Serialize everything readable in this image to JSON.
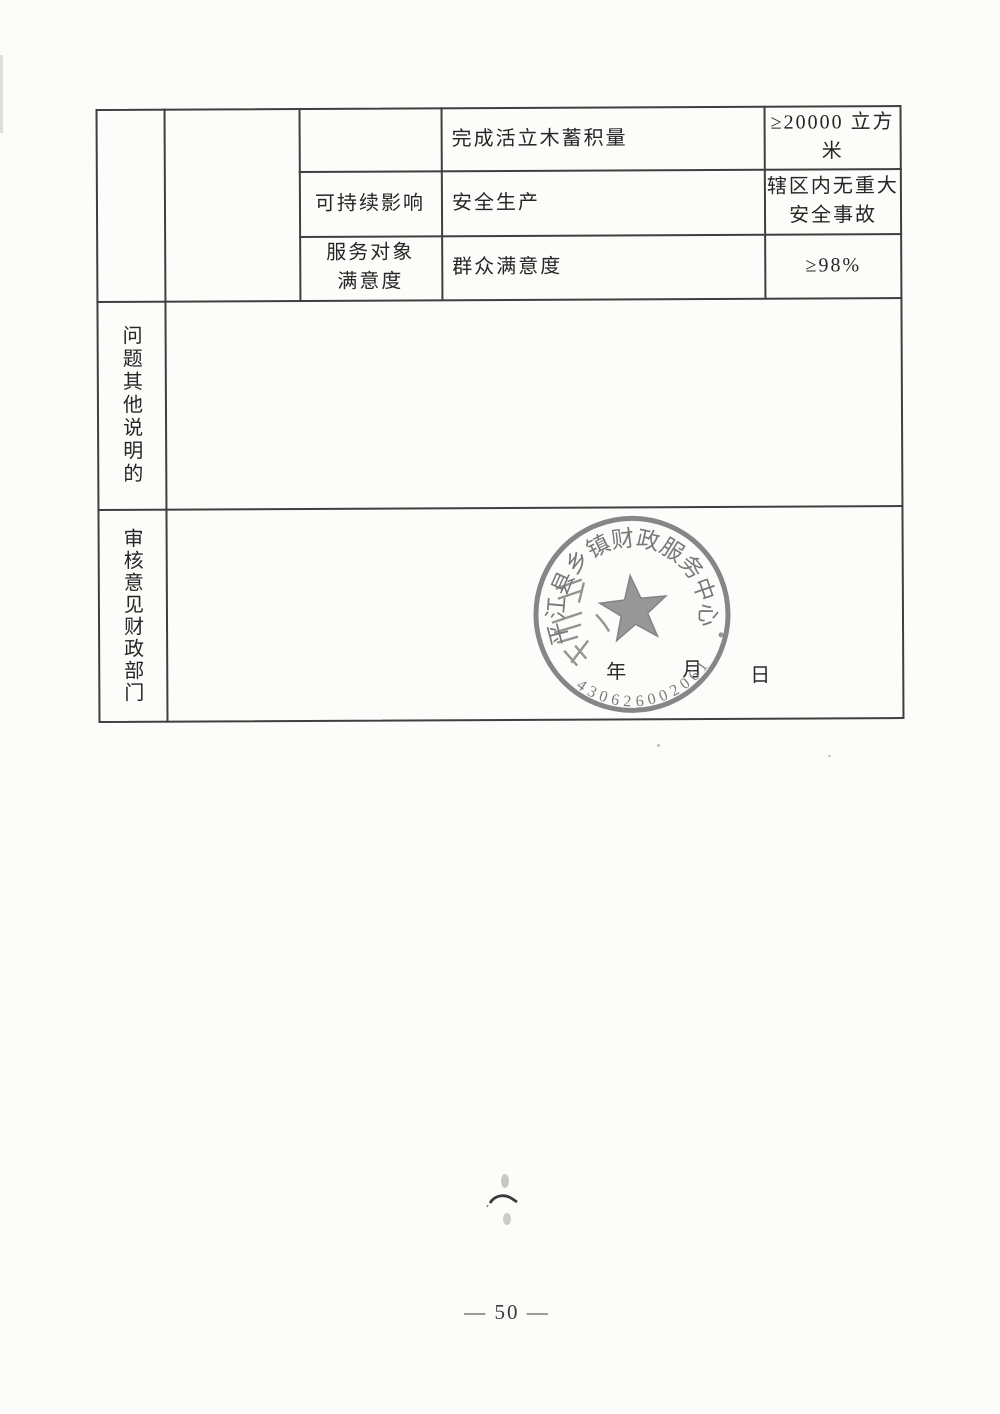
{
  "page": {
    "number_label": "— 50 —"
  },
  "colors": {
    "ink": "#262626",
    "table_line": "#3f3f3f",
    "seal_gray": "#7c7c7c",
    "paper": "#fcfcfb"
  },
  "table": {
    "top_rows": [
      {
        "group": "",
        "indicator": "完成活立木蓄积量",
        "target": "≥20000 立方\n米"
      },
      {
        "group": "可持续影响",
        "indicator": "安全生产",
        "target": "辖区内无重大\n安全事故"
      },
      {
        "group": "服务对象\n满意度",
        "indicator": "群众满意度",
        "target": "≥98%"
      }
    ],
    "other_section": {
      "label": "问题其他说明的",
      "content": ""
    },
    "review_section": {
      "label": "审核意见财政部门"
    }
  },
  "review": {
    "date": {
      "year_label": "年",
      "month_label": "月",
      "day_label": "日"
    },
    "seal": {
      "arc_text": "平江县乡镇财政服务中心",
      "number": "430626002061",
      "center_icon": "five-pointed-star"
    }
  }
}
